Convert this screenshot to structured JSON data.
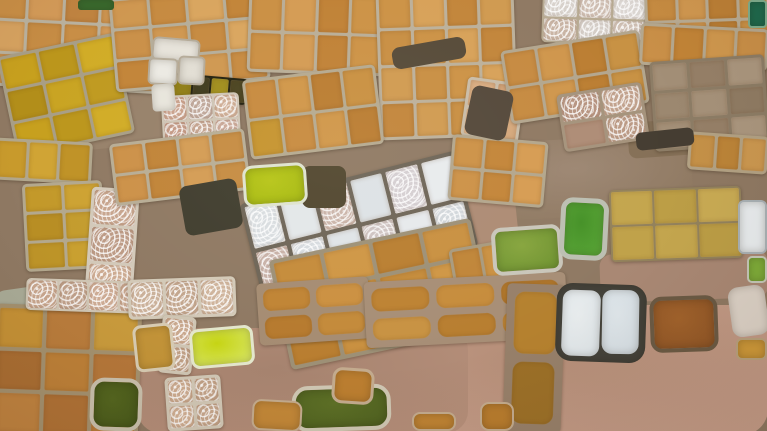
{
  "scene": {
    "width": 767,
    "height": 431,
    "base_color": "#8f7963"
  },
  "patches": [
    {
      "name": "dirt-path-topleft",
      "x": 80,
      "y": 84,
      "w": 130,
      "h": 60,
      "rot": -6,
      "radius": 12,
      "color": "#97816a"
    },
    {
      "name": "dirt-area-center-right",
      "x": 492,
      "y": 138,
      "w": 200,
      "h": 78,
      "rot": -3,
      "radius": 18,
      "color": "#9d8773",
      "color2": "#8d775f"
    },
    {
      "name": "dirt-patch-band-right",
      "x": 408,
      "y": 192,
      "w": 110,
      "h": 80,
      "rot": -6,
      "radius": 14,
      "color": "#ad8b74"
    },
    {
      "name": "dirt-area-bottom-right",
      "x": 368,
      "y": 305,
      "w": 400,
      "h": 130,
      "rot": 0,
      "radius": 26,
      "color": "#b58e78",
      "color2": "#c89f8b"
    },
    {
      "name": "dirt-area-bottom-center",
      "x": 138,
      "y": 328,
      "w": 330,
      "h": 105,
      "rot": 0,
      "radius": 22,
      "color": "#a6836f",
      "color2": "#b7907b"
    },
    {
      "name": "rocky-streak-left",
      "x": -4,
      "y": 288,
      "w": 52,
      "h": 28,
      "rot": -8,
      "radius": 10,
      "color": "#a9ab97"
    },
    {
      "name": "dirt-strip-right-mid",
      "x": 600,
      "y": 252,
      "w": 168,
      "h": 48,
      "rot": -2,
      "radius": 12,
      "color": "#a98874"
    },
    {
      "name": "dirt-under-gray-cluster",
      "x": 628,
      "y": 118,
      "w": 140,
      "h": 36,
      "rot": -4,
      "radius": 8,
      "color": "#857057"
    },
    {
      "name": "shadow-gap-top-center",
      "x": 392,
      "y": 42,
      "w": 74,
      "h": 22,
      "rot": -10,
      "radius": 8,
      "color": "#564a38",
      "layer": "over"
    },
    {
      "name": "shadow-gap-top-center-2",
      "x": 468,
      "y": 88,
      "w": 42,
      "h": 50,
      "rot": 12,
      "radius": 8,
      "color": "#54483a",
      "layer": "over"
    },
    {
      "name": "shadow-left-of-band",
      "x": 182,
      "y": 182,
      "w": 58,
      "h": 50,
      "rot": -10,
      "radius": 8,
      "color": "#403d2e",
      "layer": "over"
    },
    {
      "name": "shadow-right-of-yellow-pond",
      "x": 302,
      "y": 166,
      "w": 44,
      "h": 42,
      "rot": 0,
      "radius": 8,
      "color": "#51462e",
      "layer": "over"
    },
    {
      "name": "shadow-under-gray-cluster",
      "x": 636,
      "y": 130,
      "w": 58,
      "h": 18,
      "rot": -6,
      "radius": 6,
      "color": "#453d32",
      "layer": "over"
    }
  ],
  "clusters": [
    {
      "name": "tile-grid-topleft-orange",
      "x": -12,
      "y": -10,
      "w": 185,
      "h": 100,
      "rot": 3,
      "cols": 5,
      "rows": 3,
      "gap": 3,
      "ridge": "#b9b19e",
      "colors": [
        "#c88e46",
        "#d39a58",
        "#bf8340",
        "#cc9450",
        "#c28a42",
        "#d6a260",
        "#c68c44"
      ]
    },
    {
      "name": "tile-grid-topleft-yellow",
      "x": 6,
      "y": 44,
      "w": 120,
      "h": 102,
      "rot": -12,
      "cols": 3,
      "rows": 3,
      "gap": 3,
      "ridge": "#a89e86",
      "colors": [
        "#c7a01e",
        "#bb961c",
        "#d1ac26",
        "#b28e1a",
        "#c9a422",
        "#bf9a20"
      ]
    },
    {
      "name": "tile-grid-top-orange-b",
      "x": 112,
      "y": -8,
      "w": 155,
      "h": 94,
      "rot": -5,
      "cols": 4,
      "rows": 3,
      "gap": 3,
      "ridge": "#b5ad99",
      "colors": [
        "#cf9750",
        "#c68a40",
        "#d9a55e",
        "#c28438",
        "#ca9048"
      ]
    },
    {
      "name": "tile-strip-olive",
      "x": 172,
      "y": 76,
      "w": 76,
      "h": 26,
      "rot": 5,
      "cols": 4,
      "rows": 1,
      "gap": 2,
      "ridge": "#23210f",
      "colors": [
        "#8f7d16",
        "#3f3b1d",
        "#a08e1c",
        "#4a431f"
      ]
    },
    {
      "name": "tile-grid-texture-topleft",
      "x": 162,
      "y": 94,
      "w": 78,
      "h": 52,
      "rot": -3,
      "cols": 3,
      "rows": 2,
      "gap": 2,
      "ridge": "#cfc5b5",
      "colors": [
        "T#c9a18c",
        "T#bfa79a",
        "T#cfae96",
        "T#c49a86",
        "T#c5a490",
        "T#cba898"
      ]
    },
    {
      "name": "tile-row-left-amber",
      "x": -6,
      "y": 140,
      "w": 98,
      "h": 42,
      "rot": 3,
      "cols": 3,
      "rows": 1,
      "gap": 3,
      "ridge": "#b1a68c",
      "colors": [
        "#c89a2c",
        "#d0a434",
        "#bf9226"
      ]
    },
    {
      "name": "tile-grid-left-amber",
      "x": 24,
      "y": 182,
      "w": 80,
      "h": 88,
      "rot": -3,
      "cols": 2,
      "rows": 3,
      "gap": 3,
      "ridge": "#b3a88e",
      "colors": [
        "#c3992a",
        "#cda232",
        "#b88e24",
        "#c49c2e",
        "#bd9428",
        "#c9a030"
      ]
    },
    {
      "name": "tile-col-texture-left",
      "x": 88,
      "y": 188,
      "w": 48,
      "h": 114,
      "rot": 4,
      "cols": 1,
      "rows": 3,
      "gap": 3,
      "ridge": "#d3c9b9",
      "colors": [
        "T#c7a58e",
        "T#bd9b86",
        "T#cdab92"
      ]
    },
    {
      "name": "tile-grid-mid-orange",
      "x": 112,
      "y": 136,
      "w": 136,
      "h": 62,
      "rot": -7,
      "cols": 4,
      "rows": 2,
      "gap": 3,
      "ridge": "#b8ad95",
      "colors": [
        "#cc9148",
        "#c18438",
        "#d49c54",
        "#c68c42"
      ]
    },
    {
      "name": "tile-grid-topcenter-a",
      "x": 248,
      "y": -8,
      "w": 136,
      "h": 82,
      "rot": 2,
      "cols": 4,
      "rows": 2,
      "gap": 3,
      "ridge": "#b9ad96",
      "colors": [
        "#ca8f43",
        "#d49b53",
        "#c08135",
        "#cc9245"
      ]
    },
    {
      "name": "tile-grid-topcenter-b",
      "x": 378,
      "y": -10,
      "w": 138,
      "h": 148,
      "rot": -2,
      "cols": 4,
      "rows": 4,
      "gap": 3,
      "ridge": "#bcb09a",
      "colors": [
        "#cc9245",
        "#d7a158",
        "#c2853a",
        "#d09a50",
        "#c88e42"
      ]
    },
    {
      "name": "tile-grid-topcenter-c",
      "x": 246,
      "y": 72,
      "w": 134,
      "h": 80,
      "rot": -7,
      "cols": 4,
      "rows": 2,
      "gap": 3,
      "ridge": "#b5a98f",
      "colors": [
        "#c78a3e",
        "#d09648",
        "#ba7c30",
        "#c99040",
        "#c5932e"
      ]
    },
    {
      "name": "tile-grid-pink-tan",
      "x": 464,
      "y": 80,
      "w": 58,
      "h": 60,
      "rot": 8,
      "cols": 2,
      "rows": 2,
      "gap": 3,
      "ridge": "#c9bca8",
      "colors": [
        "#d9ad82",
        "#d2a276",
        "#dfb68c",
        "#d5a87c"
      ]
    },
    {
      "name": "tile-grid-topright-swirl",
      "x": 542,
      "y": -6,
      "w": 106,
      "h": 50,
      "rot": 2,
      "cols": 3,
      "rows": 2,
      "gap": 2,
      "ridge": "#b7aa92",
      "colors": [
        "T#d8d2cc",
        "T#cfbeb2",
        "T#ddd8d4",
        "T#c9b4a4",
        "T#d5cec8",
        "T#d1c2b6"
      ]
    },
    {
      "name": "tile-grid-topright-orange",
      "x": 645,
      "y": -8,
      "w": 125,
      "h": 56,
      "rot": -2,
      "cols": 4,
      "rows": 2,
      "gap": 3,
      "ridge": "#b9ac94",
      "colors": [
        "#c78c42",
        "#d19850",
        "#bd8036",
        "#cb9246"
      ]
    },
    {
      "name": "tile-grid-right-orange-fan",
      "x": 505,
      "y": 40,
      "w": 140,
      "h": 74,
      "rot": -9,
      "cols": 4,
      "rows": 2,
      "gap": 3,
      "ridge": "#b3a68e",
      "colors": [
        "#c68a40",
        "#cf964c",
        "#bb7e32",
        "#c89244"
      ]
    },
    {
      "name": "tile-strip-topright",
      "x": 640,
      "y": 26,
      "w": 128,
      "h": 42,
      "rot": 3,
      "cols": 4,
      "rows": 1,
      "gap": 3,
      "ridge": "#b5a88f",
      "colors": [
        "#ca9048",
        "#c28437",
        "#d0984e"
      ]
    },
    {
      "name": "tile-grid-gray-brown",
      "x": 652,
      "y": 58,
      "w": 115,
      "h": 90,
      "rot": -4,
      "cols": 3,
      "rows": 3,
      "gap": 3,
      "ridge": "#8d7d66",
      "colors": [
        "#a38f77",
        "#968068",
        "#ab977f",
        "#9c8870",
        "#a6927a",
        "#907c64"
      ]
    },
    {
      "name": "tile-grid-mauve",
      "x": 560,
      "y": 88,
      "w": 86,
      "h": 58,
      "rot": -9,
      "cols": 2,
      "rows": 2,
      "gap": 3,
      "ridge": "#a5937c",
      "colors": [
        "T#b79481",
        "T#c2a28d",
        "#ae8c76",
        "T#bb9a85"
      ]
    },
    {
      "name": "tile-band-white-salt",
      "x": 248,
      "y": 176,
      "w": 222,
      "h": 98,
      "rot": -14,
      "cols": 6,
      "rows": 2,
      "gap": 4,
      "ridge": "#6e6557",
      "colors": [
        "T#d9dde0",
        "#e3e7e9",
        "T#cbb5aa",
        "#dde2e5",
        "T#d5cfd2",
        "#e8ebed",
        "T#c9b2a8",
        "T#d8dce0",
        "#e0e4e7",
        "T#cfc4c2",
        "#e6e9ec",
        "T#d3d8dc"
      ]
    },
    {
      "name": "tile-grid-below-band-orange",
      "x": 278,
      "y": 238,
      "w": 206,
      "h": 112,
      "rot": -12,
      "cols": 4,
      "rows": 3,
      "gap": 4,
      "ridge": "#9d9076",
      "colors": [
        "#c58b3a",
        "#cf9644",
        "#b97e30",
        "#c99040",
        "#bf8536",
        "#ca9240"
      ]
    },
    {
      "name": "tile-grid-right-of-band",
      "x": 450,
      "y": 138,
      "w": 96,
      "h": 66,
      "rot": 5,
      "cols": 3,
      "rows": 2,
      "gap": 3,
      "ridge": "#b3a68c",
      "colors": [
        "#cc9146",
        "#c38538",
        "#d69c52"
      ]
    },
    {
      "name": "tile-pair-below-right-of-band",
      "x": 452,
      "y": 244,
      "w": 62,
      "h": 50,
      "rot": -10,
      "cols": 2,
      "rows": 1,
      "gap": 3,
      "ridge": "#a89a7e",
      "colors": [
        "#c08538",
        "#ca9142"
      ]
    },
    {
      "name": "field-khaki",
      "x": 610,
      "y": 188,
      "w": 132,
      "h": 72,
      "rot": -2,
      "cols": 3,
      "rows": 2,
      "gap": 2,
      "ridge": "#93825c",
      "colors": [
        "#c4a64e",
        "#bc9e46",
        "#c9ab54",
        "#c0a24a"
      ]
    },
    {
      "name": "tile-strip-right-edge",
      "x": 688,
      "y": 134,
      "w": 80,
      "h": 38,
      "rot": 4,
      "cols": 3,
      "rows": 1,
      "gap": 3,
      "ridge": "#b3a284",
      "colors": [
        "#c59148",
        "#bc8438",
        "#cc9850"
      ]
    },
    {
      "name": "tile-grid-bottomleft",
      "x": -6,
      "y": 306,
      "w": 146,
      "h": 132,
      "rot": 2,
      "cols": 3,
      "rows": 3,
      "gap": 4,
      "ridge": "#a4916f",
      "colors": [
        "#c59136",
        "#b97c3c",
        "#c89a3c",
        "#aa6e33",
        "#bd8038",
        "#b5773a",
        "#c08340",
        "#b07236",
        "#ba7c3a"
      ]
    },
    {
      "name": "tile-row-texture-bl-a",
      "x": 26,
      "y": 280,
      "w": 124,
      "h": 32,
      "rot": 2,
      "cols": 4,
      "rows": 1,
      "gap": 2,
      "ridge": "#cfc5b3",
      "colors": [
        "T#c8a68e",
        "T#bfa08a",
        "T#cdab94"
      ]
    },
    {
      "name": "tile-row-texture-bl-b",
      "x": 128,
      "y": 278,
      "w": 108,
      "h": 40,
      "rot": -2,
      "cols": 3,
      "rows": 1,
      "gap": 3,
      "ridge": "#d3c9b7",
      "colors": [
        "T#cbb19a",
        "T#c3a68e",
        "T#cfb49c"
      ]
    },
    {
      "name": "tile-col-texture-bl-c",
      "x": 160,
      "y": 316,
      "w": 34,
      "h": 58,
      "rot": 6,
      "cols": 1,
      "rows": 2,
      "gap": 3,
      "ridge": "#cfc5b3",
      "colors": [
        "T#c9a88e",
        "T#c0a086"
      ]
    },
    {
      "name": "tile-grid-texture-bl-d",
      "x": 166,
      "y": 376,
      "w": 56,
      "h": 54,
      "rot": -4,
      "cols": 2,
      "rows": 2,
      "gap": 3,
      "ridge": "#d1c7b5",
      "colors": [
        "T#ccab90",
        "T#c2a288",
        "T#d0af94",
        "T#c6a68c"
      ]
    },
    {
      "name": "pond-row-bottomcenter-a",
      "x": 258,
      "y": 280,
      "w": 112,
      "h": 62,
      "rot": -4,
      "cols": 2,
      "rows": 2,
      "gap": 6,
      "ridge": "#a58c72",
      "cellRadius": 8,
      "colors": [
        "#c08434",
        "#cb9040",
        "#b67a2e",
        "#c38a3a"
      ]
    },
    {
      "name": "pond-row-bottomcenter-b",
      "x": 365,
      "y": 277,
      "w": 202,
      "h": 66,
      "rot": -3,
      "cols": 3,
      "rows": 2,
      "gap": 7,
      "ridge": "#a78e76",
      "cellRadius": 9,
      "colors": [
        "#bd8232",
        "#c68c3c",
        "#b2782c",
        "#c89242",
        "#b87e30",
        "#c08636"
      ]
    },
    {
      "name": "pond-col-bottomright",
      "x": 505,
      "y": 284,
      "w": 58,
      "h": 148,
      "rot": 2,
      "cols": 1,
      "rows": 2,
      "gap": 8,
      "ridge": "#97806a",
      "cellRadius": 10,
      "colors": [
        "#b5812f",
        "#9c7028"
      ]
    }
  ],
  "ponds": [
    {
      "name": "pond-green-top-edge",
      "x": 78,
      "y": 0,
      "w": 36,
      "h": 10,
      "rot": 0,
      "radius": 3,
      "color": "#3a6b2e"
    },
    {
      "name": "pond-white-topleft-a",
      "x": 152,
      "y": 38,
      "w": 48,
      "h": 24,
      "rot": 5,
      "radius": 6,
      "color": "#e7e3da",
      "border": 2,
      "borderColor": "#b4aa98"
    },
    {
      "name": "pond-white-topleft-b",
      "x": 148,
      "y": 58,
      "w": 30,
      "h": 27,
      "rot": 3,
      "radius": 5,
      "color": "#eceae3",
      "border": 2,
      "borderColor": "#b4aa98"
    },
    {
      "name": "pond-white-topleft-c",
      "x": 178,
      "y": 56,
      "w": 27,
      "h": 29,
      "rot": 3,
      "radius": 5,
      "color": "#e2ded4",
      "border": 2,
      "borderColor": "#b4aa98"
    },
    {
      "name": "pond-white-strip",
      "x": 152,
      "y": 84,
      "w": 23,
      "h": 27,
      "rot": -4,
      "radius": 4,
      "color": "#e8e5dc"
    },
    {
      "name": "pond-teal-topright",
      "x": 748,
      "y": 0,
      "w": 19,
      "h": 28,
      "rot": 0,
      "radius": 4,
      "color": "#1e6b4e",
      "border": 2,
      "borderColor": "#7fae8e"
    },
    {
      "name": "pond-yellowgreen-center",
      "x": 243,
      "y": 164,
      "w": 64,
      "h": 42,
      "rot": -4,
      "radius": 10,
      "color": "#b7c517",
      "color2": "#a4b80e",
      "border": 3,
      "borderColor": "#dfe3cf"
    },
    {
      "name": "pond-green-murky",
      "x": 492,
      "y": 226,
      "w": 70,
      "h": 48,
      "rot": -4,
      "radius": 10,
      "color": "#87a53e",
      "color2": "#6d9230",
      "border": 4,
      "borderColor": "#c9c6ba"
    },
    {
      "name": "pond-green-bright",
      "x": 560,
      "y": 198,
      "w": 48,
      "h": 62,
      "rot": 3,
      "radius": 12,
      "color": "#459127",
      "color2": "#5aa637",
      "border": 5,
      "borderColor": "#bcbfb2"
    },
    {
      "name": "pond-white-right-edge",
      "x": 738,
      "y": 200,
      "w": 29,
      "h": 54,
      "rot": 0,
      "radius": 6,
      "color": "#e9edef",
      "border": 2,
      "borderColor": "#a9b1b5"
    },
    {
      "name": "pond-green-right-edge",
      "x": 747,
      "y": 256,
      "w": 20,
      "h": 27,
      "rot": 0,
      "radius": 5,
      "color": "#7fae3a",
      "border": 2,
      "borderColor": "#c5c8b8"
    },
    {
      "name": "pond-olive-bottomleft",
      "x": 90,
      "y": 378,
      "w": 52,
      "h": 53,
      "rot": 2,
      "radius": 14,
      "color": "#54661f",
      "color2": "#46571a",
      "border": 4,
      "borderColor": "#c9c0ac"
    },
    {
      "name": "pond-tan-small",
      "x": 134,
      "y": 324,
      "w": 40,
      "h": 47,
      "rot": -6,
      "radius": 8,
      "color": "#c29338",
      "border": 3,
      "borderColor": "#d7cbb2"
    },
    {
      "name": "pond-yellow-bright-bottom",
      "x": 190,
      "y": 327,
      "w": 64,
      "h": 40,
      "rot": -5,
      "radius": 9,
      "color": "#c6d414",
      "color2": "#d8e668",
      "border": 3,
      "borderColor": "#e3e6cc"
    },
    {
      "name": "pond-darkgreen-bottomcenter",
      "x": 292,
      "y": 385,
      "w": 99,
      "h": 46,
      "rot": -2,
      "radius": 16,
      "color": "#5d7026",
      "color2": "#4e6020",
      "border": 4,
      "borderColor": "#cfc7b3"
    },
    {
      "name": "pond-orange-small-a",
      "x": 332,
      "y": 368,
      "w": 42,
      "h": 36,
      "rot": 4,
      "radius": 10,
      "color": "#bb7e30",
      "border": 3,
      "borderColor": "#c3ab8e"
    },
    {
      "name": "pond-orange-small-b",
      "x": 252,
      "y": 400,
      "w": 50,
      "h": 31,
      "rot": 3,
      "radius": 9,
      "color": "#c28738",
      "border": 2,
      "borderColor": "#c3ab8e"
    },
    {
      "name": "pond-orange-small-c",
      "x": 412,
      "y": 412,
      "w": 44,
      "h": 19,
      "rot": 0,
      "radius": 8,
      "color": "#c08434",
      "border": 2,
      "borderColor": "#c3ab8e"
    },
    {
      "name": "pond-orange-small-d",
      "x": 480,
      "y": 402,
      "w": 34,
      "h": 29,
      "rot": 0,
      "radius": 9,
      "color": "#b87c2e",
      "border": 2,
      "borderColor": "#c3ab8e"
    },
    {
      "name": "pond-white-pair-rim",
      "x": 556,
      "y": 284,
      "w": 90,
      "h": 78,
      "rot": 2,
      "radius": 16,
      "color": "#44423a"
    },
    {
      "name": "pond-white-pair-left",
      "x": 562,
      "y": 290,
      "w": 38,
      "h": 66,
      "rot": 2,
      "radius": 10,
      "color": "#e8eced",
      "color2": "#dce3e7"
    },
    {
      "name": "pond-white-pair-right",
      "x": 602,
      "y": 290,
      "w": 37,
      "h": 64,
      "rot": 1,
      "radius": 10,
      "color": "#dfe6ea",
      "color2": "#d3dce2"
    },
    {
      "name": "pond-redbrown",
      "x": 650,
      "y": 296,
      "w": 68,
      "h": 56,
      "rot": -2,
      "radius": 12,
      "color": "#a2632c",
      "color2": "#8f5526",
      "border": 4,
      "borderColor": "#6b5a44"
    },
    {
      "name": "pond-white-farright",
      "x": 730,
      "y": 286,
      "w": 37,
      "h": 50,
      "rot": -8,
      "radius": 10,
      "color": "#ddd3c8"
    },
    {
      "name": "pond-orange-right-edge",
      "x": 736,
      "y": 338,
      "w": 31,
      "h": 22,
      "rot": 0,
      "radius": 6,
      "color": "#cf9a3a",
      "border": 2,
      "borderColor": "#b9a27e"
    }
  ]
}
